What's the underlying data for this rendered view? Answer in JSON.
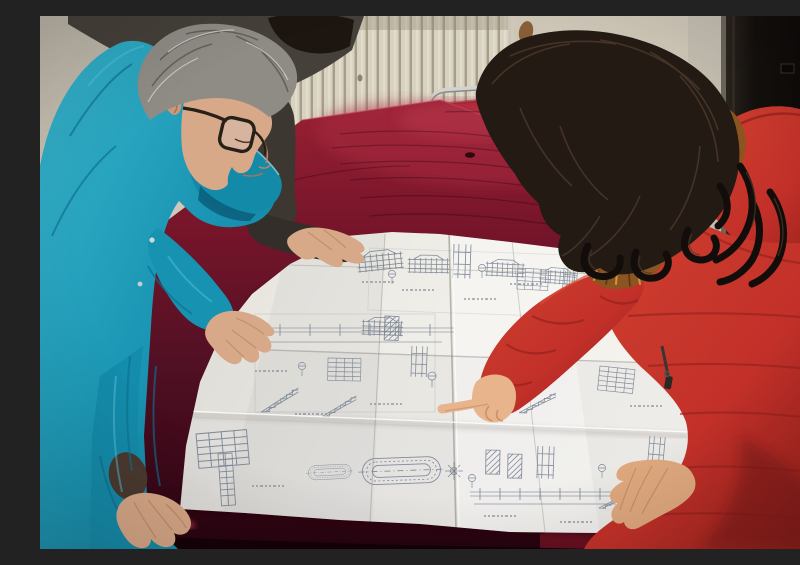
{
  "scene": {
    "title": "Reviewing construction blueprints",
    "description": "Indoor photograph: a man in a teal work jacket with glasses and gray hair leans over a large folded construction blueprint spread on a dark red velvet-covered table, while a woman in a red down coat with an orange fur-trimmed hood points at a detail on the drawing. A colleague in a dark jacket stands behind the man with one hand on the sheet. Behind them are a pale ribbed radiator wall, a red chair with a chrome frame, and a dark door on the right.",
    "people": [
      {
        "id": "worker-left",
        "description": "middle-aged man, gray hair, dark-rimmed glasses, teal work jacket, both hands on blueprint"
      },
      {
        "id": "colleague-behind",
        "description": "person in dark gray-brown jacket with black hair, hand resting on blueprint"
      },
      {
        "id": "woman-right",
        "description": "woman with long dark wavy hair, red quilted down coat with orange fur hood, pointing at blueprint"
      }
    ],
    "objects": [
      {
        "id": "blueprint",
        "description": "large white folded architectural drawing sheet with elevations, stair sections, detail tables and an oval track detail"
      },
      {
        "id": "table",
        "description": "table covered with dark burgundy velvet cloth"
      },
      {
        "id": "radiator",
        "description": "pale vertical-ribbed radiator against the back wall"
      },
      {
        "id": "chair",
        "description": "red upholstered chair with chrome tube frame behind the table"
      },
      {
        "id": "door",
        "description": "dark door with pale frame on the right"
      }
    ],
    "palette": {
      "wall": "#c9c3b4",
      "radiator": "#d8d2c2",
      "door": "#14100d",
      "door_frame": "#c0bbae",
      "chair_red": "#b3202b",
      "chrome": "#d2d2ce",
      "velvet_highlight": "#9a2134",
      "velvet_shadow": "#3a0818",
      "paper": "#efede7",
      "blueprint_ink": "#7c8696",
      "teal_jacket": "#1b97b5",
      "gray_hair": "#8f8c86",
      "skin": "#d8a988",
      "dark_jacket": "#45403a",
      "black_hair": "#1c1510",
      "red_coat": "#c23029",
      "fur_trim": "#c97c2e"
    }
  }
}
